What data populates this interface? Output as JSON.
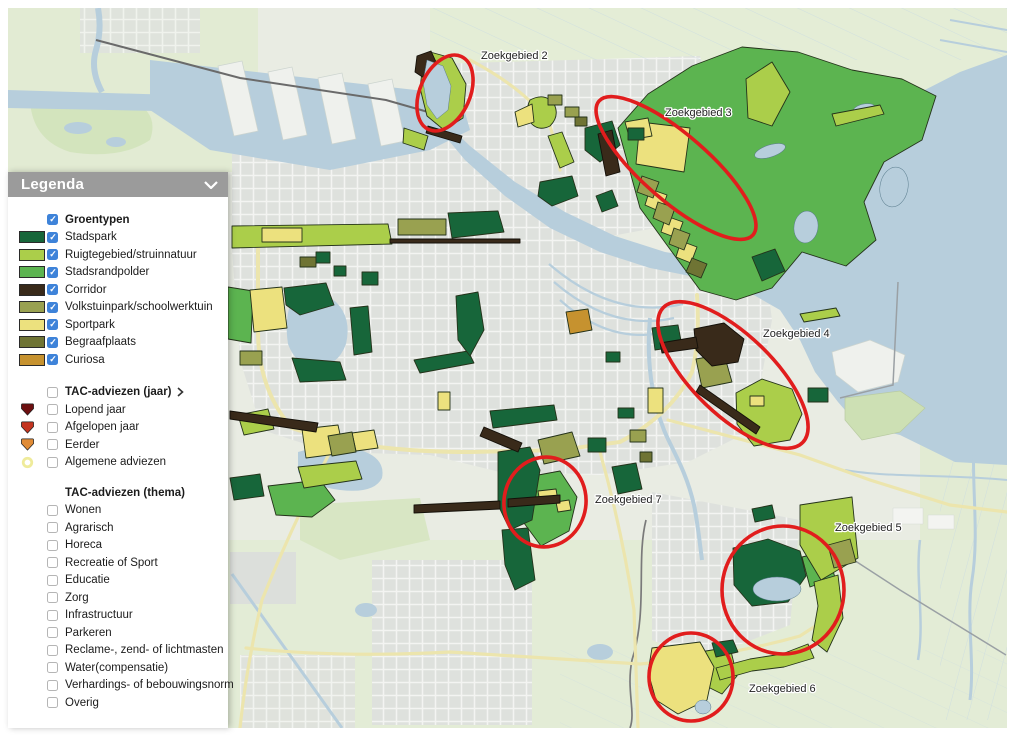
{
  "palette": {
    "stadspark": "#17663a",
    "ruigte": "#abce4a",
    "randpolder": "#5cb450",
    "corridor": "#392a1a",
    "volkstuin": "#99a150",
    "sportpark": "#ece17e",
    "begraaf": "#6f7434",
    "curiosa": "#c6922f",
    "tac_lopend": "#6d0f10",
    "tac_afgelopen": "#c43420",
    "tac_eerder": "#e08b36",
    "tac_algemeen": "#efeb9b",
    "zoek_red": "#e11d1d",
    "water": "#b7cedc",
    "rural": "#e2ebd3",
    "urban": "#dee1dd",
    "land": "#e9ece3",
    "header_gray": "#9b9b9b"
  },
  "legend": {
    "title": "Legenda",
    "groentypen": {
      "label": "Groentypen",
      "checked": true,
      "items": [
        {
          "label": "Stadspark",
          "checked": true
        },
        {
          "label": "Ruigtegebied/struinnatuur",
          "checked": true
        },
        {
          "label": "Stadsrandpolder",
          "checked": true
        },
        {
          "label": "Corridor",
          "checked": true
        },
        {
          "label": "Volkstuinpark/schoolwerktuin",
          "checked": true
        },
        {
          "label": "Sportpark",
          "checked": true
        },
        {
          "label": "Begraafplaats",
          "checked": true
        },
        {
          "label": "Curiosa",
          "checked": true
        }
      ]
    },
    "tac_jaar": {
      "label": "TAC-adviezen (jaar)",
      "checked": false,
      "items": [
        {
          "label": "Lopend jaar",
          "checked": false
        },
        {
          "label": "Afgelopen jaar",
          "checked": false
        },
        {
          "label": "Eerder",
          "checked": false
        },
        {
          "label": "Algemene adviezen",
          "checked": false
        }
      ]
    },
    "tac_thema": {
      "label": "TAC-adviezen (thema)",
      "items": [
        "Wonen",
        "Agrarisch",
        "Horeca",
        "Recreatie of Sport",
        "Educatie",
        "Zorg",
        "Infrastructuur",
        "Parkeren",
        "Reclame-, zend- of lichtmasten",
        "Water(compensatie)",
        "Verhardings- of bebouwingsnorm",
        "Overig"
      ]
    }
  },
  "map": {
    "labels": [
      {
        "text": "Zoekgebied 2"
      },
      {
        "text": "Zoekgebied 3"
      },
      {
        "text": "Zoekgebied 4"
      },
      {
        "text": "Zoekgebied 5"
      },
      {
        "text": "Zoekgebied 6"
      },
      {
        "text": "Zoekgebied 7"
      }
    ]
  }
}
